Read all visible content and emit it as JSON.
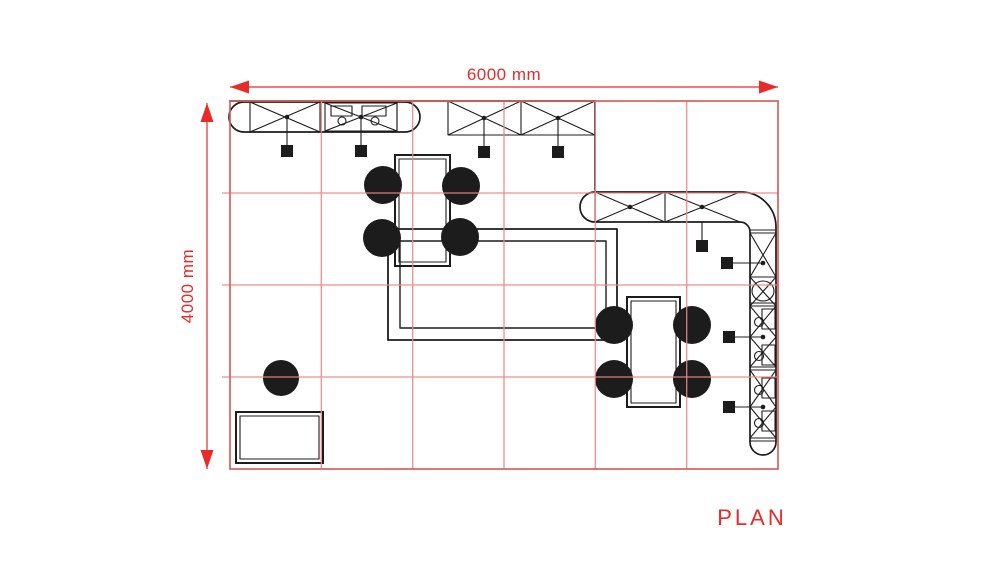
{
  "drawing": {
    "title_label": "PLAN",
    "dimensions": {
      "horizontal_label": "6000 mm",
      "vertical_label": "4000 mm"
    },
    "grid": {
      "columns": 6,
      "rows": 4,
      "cell_mm": 1000
    }
  },
  "colors": {
    "dimension": "#ea2a2a",
    "boundary": "#db5f5f",
    "grid": "#f28580",
    "ink": "#1c1c1c",
    "background": "#ffffff"
  },
  "furniture": {
    "four_seat_tables": 2,
    "round_chairs": 9,
    "low_table": 1,
    "counters": [
      "stadium-counter-with-sinks",
      "open-truss-canopy",
      "l-shaped-station-counter"
    ],
    "pendant_lights": 5,
    "wall_lights": 3
  }
}
